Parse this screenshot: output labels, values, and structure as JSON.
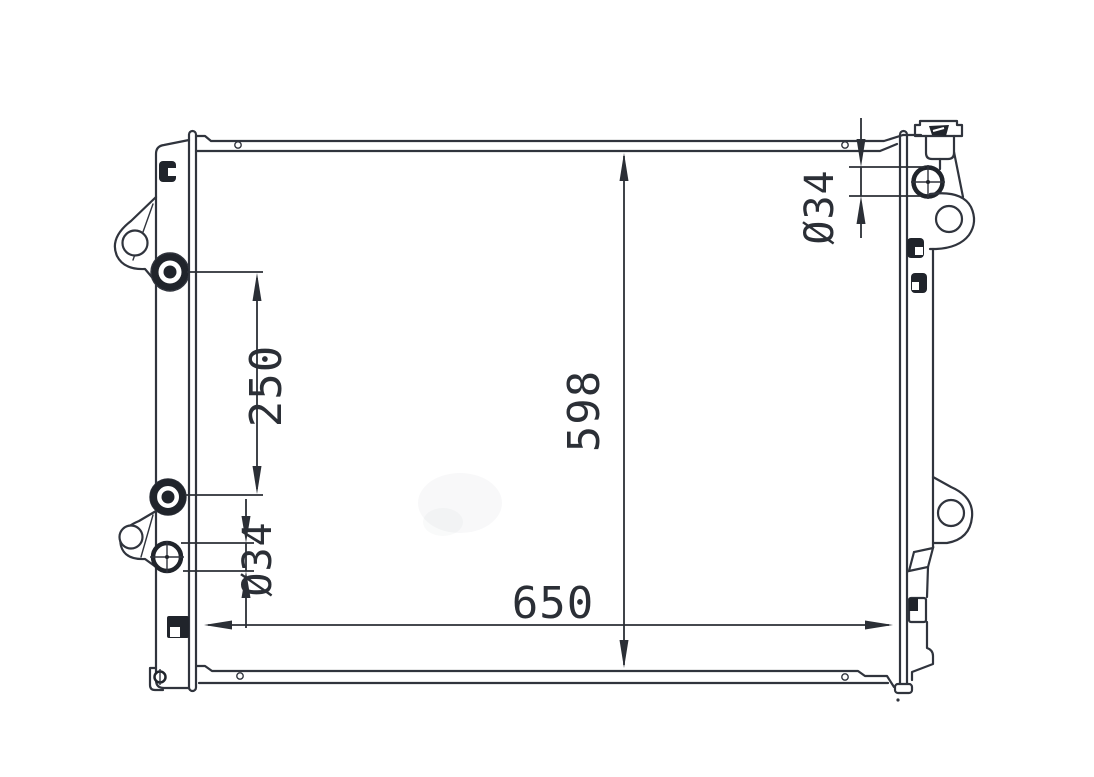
{
  "drawing": {
    "background_color": "#ffffff",
    "line_color": "#30343d",
    "dimension_labels": {
      "port_spacing": "250",
      "core_height": "598",
      "core_width": "650",
      "left_port_diameter": "Ø34",
      "right_port_diameter": "Ø34"
    }
  }
}
